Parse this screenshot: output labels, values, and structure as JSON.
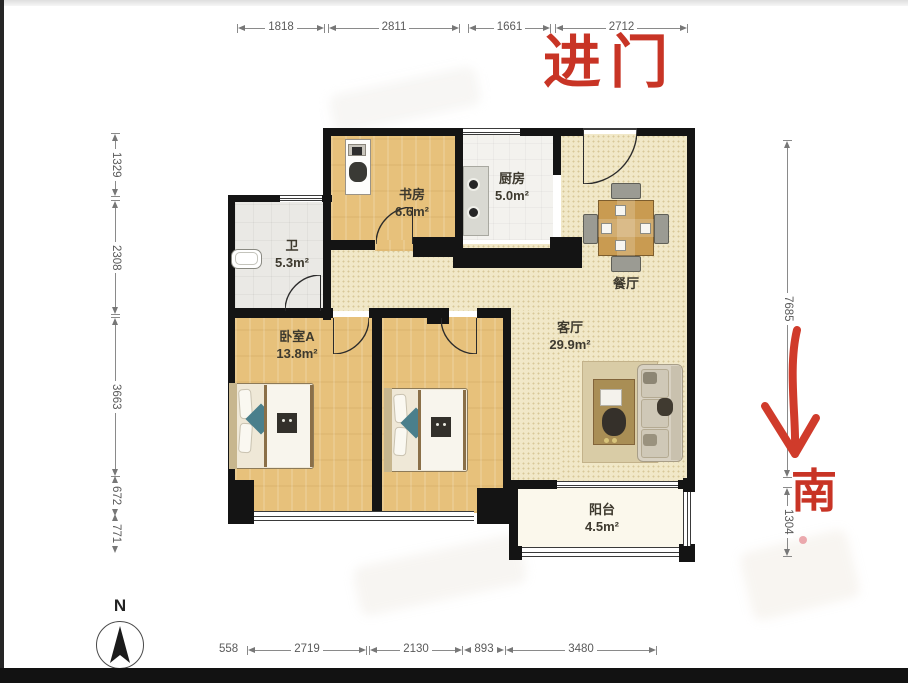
{
  "annotations": {
    "entrance": "进门",
    "south": "南",
    "compass_north": "N"
  },
  "rooms": {
    "study": {
      "label": "书房",
      "area": "6.6m²"
    },
    "kitchen": {
      "label": "厨房",
      "area": "5.0m²"
    },
    "bath": {
      "label": "卫",
      "area": "5.3m²"
    },
    "dining": {
      "label": "餐厅",
      "area": ""
    },
    "living": {
      "label": "客厅",
      "area": "29.9m²"
    },
    "bedroomA": {
      "label": "卧室A",
      "area": "13.8m²"
    },
    "balcony": {
      "label": "阳台",
      "area": "4.5m²"
    }
  },
  "dimensions": {
    "top": [
      "1818",
      "2811",
      "1661",
      "2712"
    ],
    "left": [
      "1329",
      "2308",
      "3663",
      "672",
      "771"
    ],
    "right": [
      "7685",
      "1304"
    ],
    "bottom": [
      "558",
      "2719",
      "2130",
      "893",
      "3480"
    ]
  },
  "colors": {
    "wall": "#141414",
    "wood_floor": "#e7c17b",
    "beige_floor": "#f1e8c8",
    "accent_red": "#c83425"
  }
}
